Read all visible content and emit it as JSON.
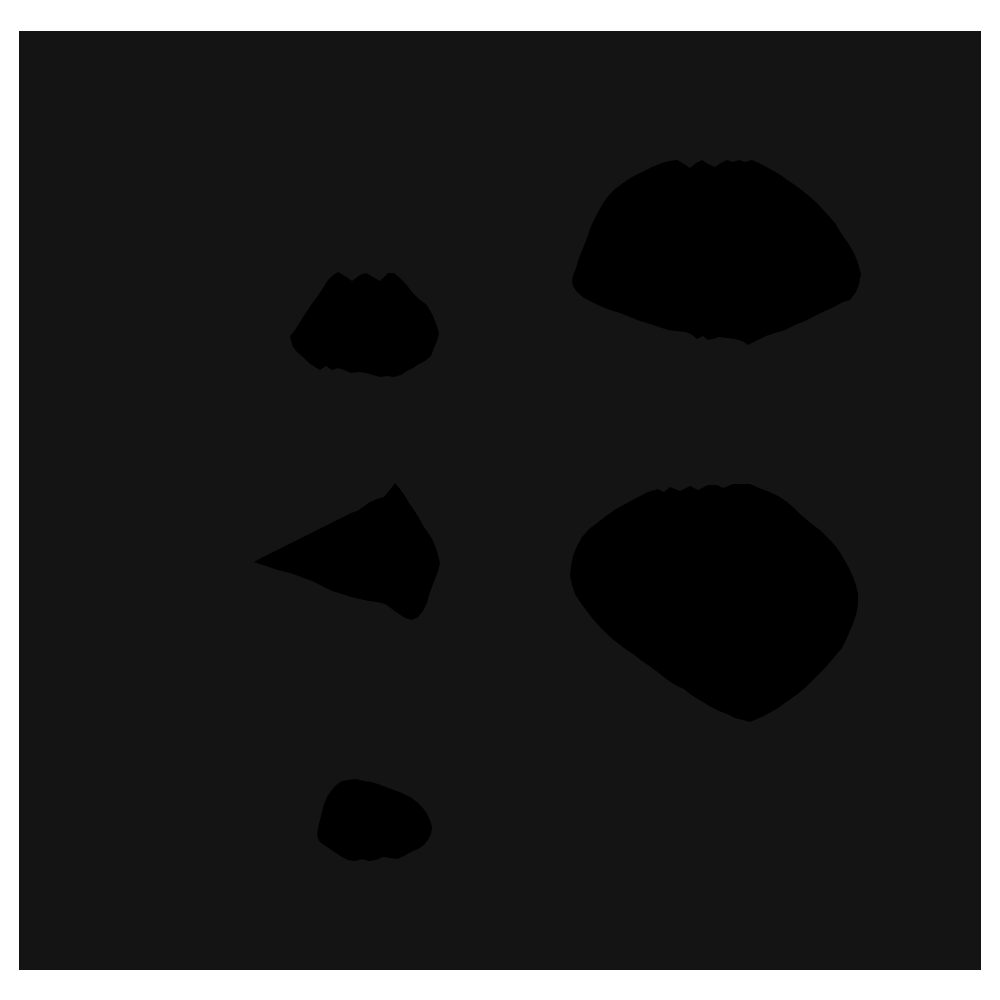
{
  "figure": {
    "page_background": "#ffffff",
    "canvas_background": "#141414",
    "canvas_rect_px": {
      "x": 19,
      "y": 31,
      "width": 962,
      "height": 939
    }
  },
  "chart_data": {
    "type": "area",
    "subtype": "filled-irregular-polygons",
    "title": "",
    "xlabel": "",
    "ylabel": "",
    "axes_visible": false,
    "grid": false,
    "legend": null,
    "coordinate_space": "image pixels, 1000x1000, y-down",
    "shape_fill": "#000000",
    "polygon_count": 5,
    "polygons": [
      {
        "name": "blob-top-left-small",
        "bbox_px": [
          290,
          272,
          439,
          378
        ],
        "points": [
          [
            332,
            276
          ],
          [
            338,
            272
          ],
          [
            345,
            276
          ],
          [
            352,
            281
          ],
          [
            360,
            275
          ],
          [
            366,
            273
          ],
          [
            373,
            277
          ],
          [
            380,
            281
          ],
          [
            388,
            273
          ],
          [
            394,
            273
          ],
          [
            400,
            278
          ],
          [
            406,
            284
          ],
          [
            412,
            292
          ],
          [
            419,
            299
          ],
          [
            427,
            305
          ],
          [
            432,
            314
          ],
          [
            436,
            323
          ],
          [
            439,
            333
          ],
          [
            437,
            341
          ],
          [
            434,
            348
          ],
          [
            431,
            356
          ],
          [
            425,
            361
          ],
          [
            419,
            364
          ],
          [
            413,
            368
          ],
          [
            407,
            371
          ],
          [
            401,
            375
          ],
          [
            394,
            377
          ],
          [
            387,
            376
          ],
          [
            380,
            377
          ],
          [
            373,
            375
          ],
          [
            366,
            373
          ],
          [
            359,
            372
          ],
          [
            351,
            373
          ],
          [
            344,
            370
          ],
          [
            338,
            368
          ],
          [
            332,
            370
          ],
          [
            326,
            366
          ],
          [
            320,
            370
          ],
          [
            315,
            367
          ],
          [
            309,
            363
          ],
          [
            304,
            358
          ],
          [
            297,
            352
          ],
          [
            293,
            347
          ],
          [
            291,
            341
          ],
          [
            290,
            336
          ],
          [
            295,
            330
          ],
          [
            300,
            322
          ],
          [
            305,
            314
          ],
          [
            311,
            305
          ],
          [
            317,
            297
          ],
          [
            323,
            288
          ],
          [
            328,
            280
          ]
        ]
      },
      {
        "name": "blob-top-right-large",
        "bbox_px": [
          572,
          158,
          861,
          346
        ],
        "points": [
          [
            677,
            160
          ],
          [
            684,
            164
          ],
          [
            690,
            168
          ],
          [
            696,
            163
          ],
          [
            702,
            160
          ],
          [
            708,
            164
          ],
          [
            715,
            167
          ],
          [
            721,
            163
          ],
          [
            727,
            160
          ],
          [
            733,
            162
          ],
          [
            739,
            160
          ],
          [
            745,
            162
          ],
          [
            752,
            160
          ],
          [
            761,
            164
          ],
          [
            770,
            169
          ],
          [
            779,
            174
          ],
          [
            789,
            181
          ],
          [
            799,
            188
          ],
          [
            809,
            196
          ],
          [
            818,
            204
          ],
          [
            827,
            214
          ],
          [
            835,
            223
          ],
          [
            841,
            233
          ],
          [
            848,
            243
          ],
          [
            854,
            253
          ],
          [
            858,
            263
          ],
          [
            861,
            274
          ],
          [
            859,
            284
          ],
          [
            856,
            292
          ],
          [
            850,
            300
          ],
          [
            843,
            302
          ],
          [
            834,
            307
          ],
          [
            825,
            311
          ],
          [
            815,
            316
          ],
          [
            805,
            321
          ],
          [
            795,
            325
          ],
          [
            785,
            330
          ],
          [
            775,
            333
          ],
          [
            766,
            336
          ],
          [
            758,
            340
          ],
          [
            754,
            342
          ],
          [
            748,
            345
          ],
          [
            742,
            341
          ],
          [
            735,
            339
          ],
          [
            727,
            338
          ],
          [
            719,
            337
          ],
          [
            713,
            339
          ],
          [
            708,
            340
          ],
          [
            703,
            336
          ],
          [
            697,
            339
          ],
          [
            691,
            334
          ],
          [
            685,
            332
          ],
          [
            676,
            331
          ],
          [
            668,
            330
          ],
          [
            659,
            327
          ],
          [
            650,
            324
          ],
          [
            640,
            321
          ],
          [
            630,
            317
          ],
          [
            620,
            313
          ],
          [
            610,
            310
          ],
          [
            600,
            306
          ],
          [
            592,
            302
          ],
          [
            584,
            298
          ],
          [
            577,
            292
          ],
          [
            573,
            286
          ],
          [
            572,
            281
          ],
          [
            573,
            276
          ],
          [
            576,
            268
          ],
          [
            579,
            258
          ],
          [
            583,
            248
          ],
          [
            587,
            238
          ],
          [
            590,
            229
          ],
          [
            592,
            224
          ],
          [
            597,
            214
          ],
          [
            602,
            205
          ],
          [
            608,
            196
          ],
          [
            615,
            189
          ],
          [
            623,
            183
          ],
          [
            632,
            177
          ],
          [
            642,
            172
          ],
          [
            652,
            167
          ],
          [
            662,
            163
          ],
          [
            669,
            161
          ]
        ]
      },
      {
        "name": "blob-middle-left",
        "bbox_px": [
          254,
          483,
          440,
          620
        ],
        "points": [
          [
            395,
            483
          ],
          [
            400,
            489
          ],
          [
            405,
            496
          ],
          [
            409,
            503
          ],
          [
            414,
            510
          ],
          [
            419,
            518
          ],
          [
            424,
            527
          ],
          [
            429,
            534
          ],
          [
            433,
            541
          ],
          [
            436,
            548
          ],
          [
            438,
            555
          ],
          [
            440,
            563
          ],
          [
            438,
            571
          ],
          [
            435,
            579
          ],
          [
            432,
            587
          ],
          [
            429,
            595
          ],
          [
            427,
            603
          ],
          [
            423,
            611
          ],
          [
            418,
            617
          ],
          [
            412,
            620
          ],
          [
            405,
            618
          ],
          [
            399,
            614
          ],
          [
            392,
            609
          ],
          [
            385,
            604
          ],
          [
            377,
            602
          ],
          [
            369,
            601
          ],
          [
            360,
            599
          ],
          [
            351,
            597
          ],
          [
            342,
            594
          ],
          [
            332,
            591
          ],
          [
            322,
            586
          ],
          [
            312,
            581
          ],
          [
            301,
            577
          ],
          [
            290,
            573
          ],
          [
            278,
            570
          ],
          [
            266,
            566
          ],
          [
            254,
            562
          ],
          [
            263,
            557
          ],
          [
            273,
            552
          ],
          [
            283,
            547
          ],
          [
            293,
            542
          ],
          [
            303,
            537
          ],
          [
            313,
            532
          ],
          [
            323,
            527
          ],
          [
            333,
            522
          ],
          [
            343,
            517
          ],
          [
            351,
            513
          ],
          [
            357,
            511
          ],
          [
            363,
            507
          ],
          [
            370,
            502
          ],
          [
            377,
            499
          ],
          [
            384,
            497
          ],
          [
            389,
            491
          ]
        ]
      },
      {
        "name": "blob-middle-right-large",
        "bbox_px": [
          570,
          484,
          858,
          722
        ],
        "points": [
          [
            597,
            523
          ],
          [
            606,
            516
          ],
          [
            616,
            509
          ],
          [
            627,
            503
          ],
          [
            638,
            497
          ],
          [
            648,
            492
          ],
          [
            658,
            489
          ],
          [
            664,
            492
          ],
          [
            670,
            487
          ],
          [
            680,
            491
          ],
          [
            690,
            486
          ],
          [
            698,
            490
          ],
          [
            708,
            485
          ],
          [
            717,
            485
          ],
          [
            723,
            488
          ],
          [
            733,
            484
          ],
          [
            750,
            484
          ],
          [
            759,
            488
          ],
          [
            767,
            491
          ],
          [
            774,
            494
          ],
          [
            780,
            497
          ],
          [
            787,
            502
          ],
          [
            793,
            507
          ],
          [
            800,
            514
          ],
          [
            807,
            520
          ],
          [
            813,
            525
          ],
          [
            820,
            530
          ],
          [
            826,
            536
          ],
          [
            832,
            542
          ],
          [
            837,
            548
          ],
          [
            841,
            554
          ],
          [
            845,
            561
          ],
          [
            849,
            568
          ],
          [
            853,
            577
          ],
          [
            856,
            585
          ],
          [
            858,
            594
          ],
          [
            858,
            603
          ],
          [
            857,
            611
          ],
          [
            855,
            618
          ],
          [
            852,
            626
          ],
          [
            849,
            633
          ],
          [
            846,
            640
          ],
          [
            842,
            648
          ],
          [
            837,
            654
          ],
          [
            831,
            661
          ],
          [
            825,
            668
          ],
          [
            819,
            674
          ],
          [
            812,
            681
          ],
          [
            806,
            687
          ],
          [
            799,
            693
          ],
          [
            792,
            698
          ],
          [
            785,
            703
          ],
          [
            778,
            708
          ],
          [
            771,
            712
          ],
          [
            764,
            716
          ],
          [
            757,
            719
          ],
          [
            750,
            722
          ],
          [
            743,
            720
          ],
          [
            735,
            718
          ],
          [
            727,
            714
          ],
          [
            719,
            711
          ],
          [
            711,
            707
          ],
          [
            703,
            702
          ],
          [
            696,
            698
          ],
          [
            690,
            694
          ],
          [
            684,
            689
          ],
          [
            677,
            686
          ],
          [
            669,
            681
          ],
          [
            660,
            674
          ],
          [
            651,
            667
          ],
          [
            642,
            661
          ],
          [
            633,
            654
          ],
          [
            624,
            648
          ],
          [
            615,
            641
          ],
          [
            607,
            634
          ],
          [
            599,
            626
          ],
          [
            592,
            618
          ],
          [
            586,
            610
          ],
          [
            580,
            602
          ],
          [
            575,
            594
          ],
          [
            572,
            585
          ],
          [
            570,
            576
          ],
          [
            571,
            566
          ],
          [
            573,
            556
          ],
          [
            577,
            546
          ],
          [
            582,
            537
          ],
          [
            589,
            529
          ]
        ]
      },
      {
        "name": "blob-bottom-small",
        "bbox_px": [
          317,
          779,
          432,
          862
        ],
        "points": [
          [
            348,
            780
          ],
          [
            356,
            779
          ],
          [
            364,
            781
          ],
          [
            371,
            782
          ],
          [
            378,
            784
          ],
          [
            386,
            787
          ],
          [
            394,
            790
          ],
          [
            402,
            793
          ],
          [
            410,
            797
          ],
          [
            417,
            802
          ],
          [
            423,
            808
          ],
          [
            427,
            814
          ],
          [
            430,
            820
          ],
          [
            432,
            827
          ],
          [
            431,
            834
          ],
          [
            428,
            840
          ],
          [
            424,
            845
          ],
          [
            418,
            849
          ],
          [
            411,
            852
          ],
          [
            404,
            856
          ],
          [
            397,
            859
          ],
          [
            390,
            858
          ],
          [
            383,
            857
          ],
          [
            376,
            860
          ],
          [
            369,
            861
          ],
          [
            362,
            859
          ],
          [
            355,
            861
          ],
          [
            348,
            860
          ],
          [
            342,
            857
          ],
          [
            336,
            853
          ],
          [
            330,
            849
          ],
          [
            324,
            845
          ],
          [
            319,
            841
          ],
          [
            317,
            835
          ],
          [
            318,
            828
          ],
          [
            320,
            820
          ],
          [
            322,
            812
          ],
          [
            324,
            804
          ],
          [
            327,
            797
          ],
          [
            331,
            791
          ],
          [
            336,
            785
          ],
          [
            342,
            781
          ]
        ]
      }
    ]
  }
}
